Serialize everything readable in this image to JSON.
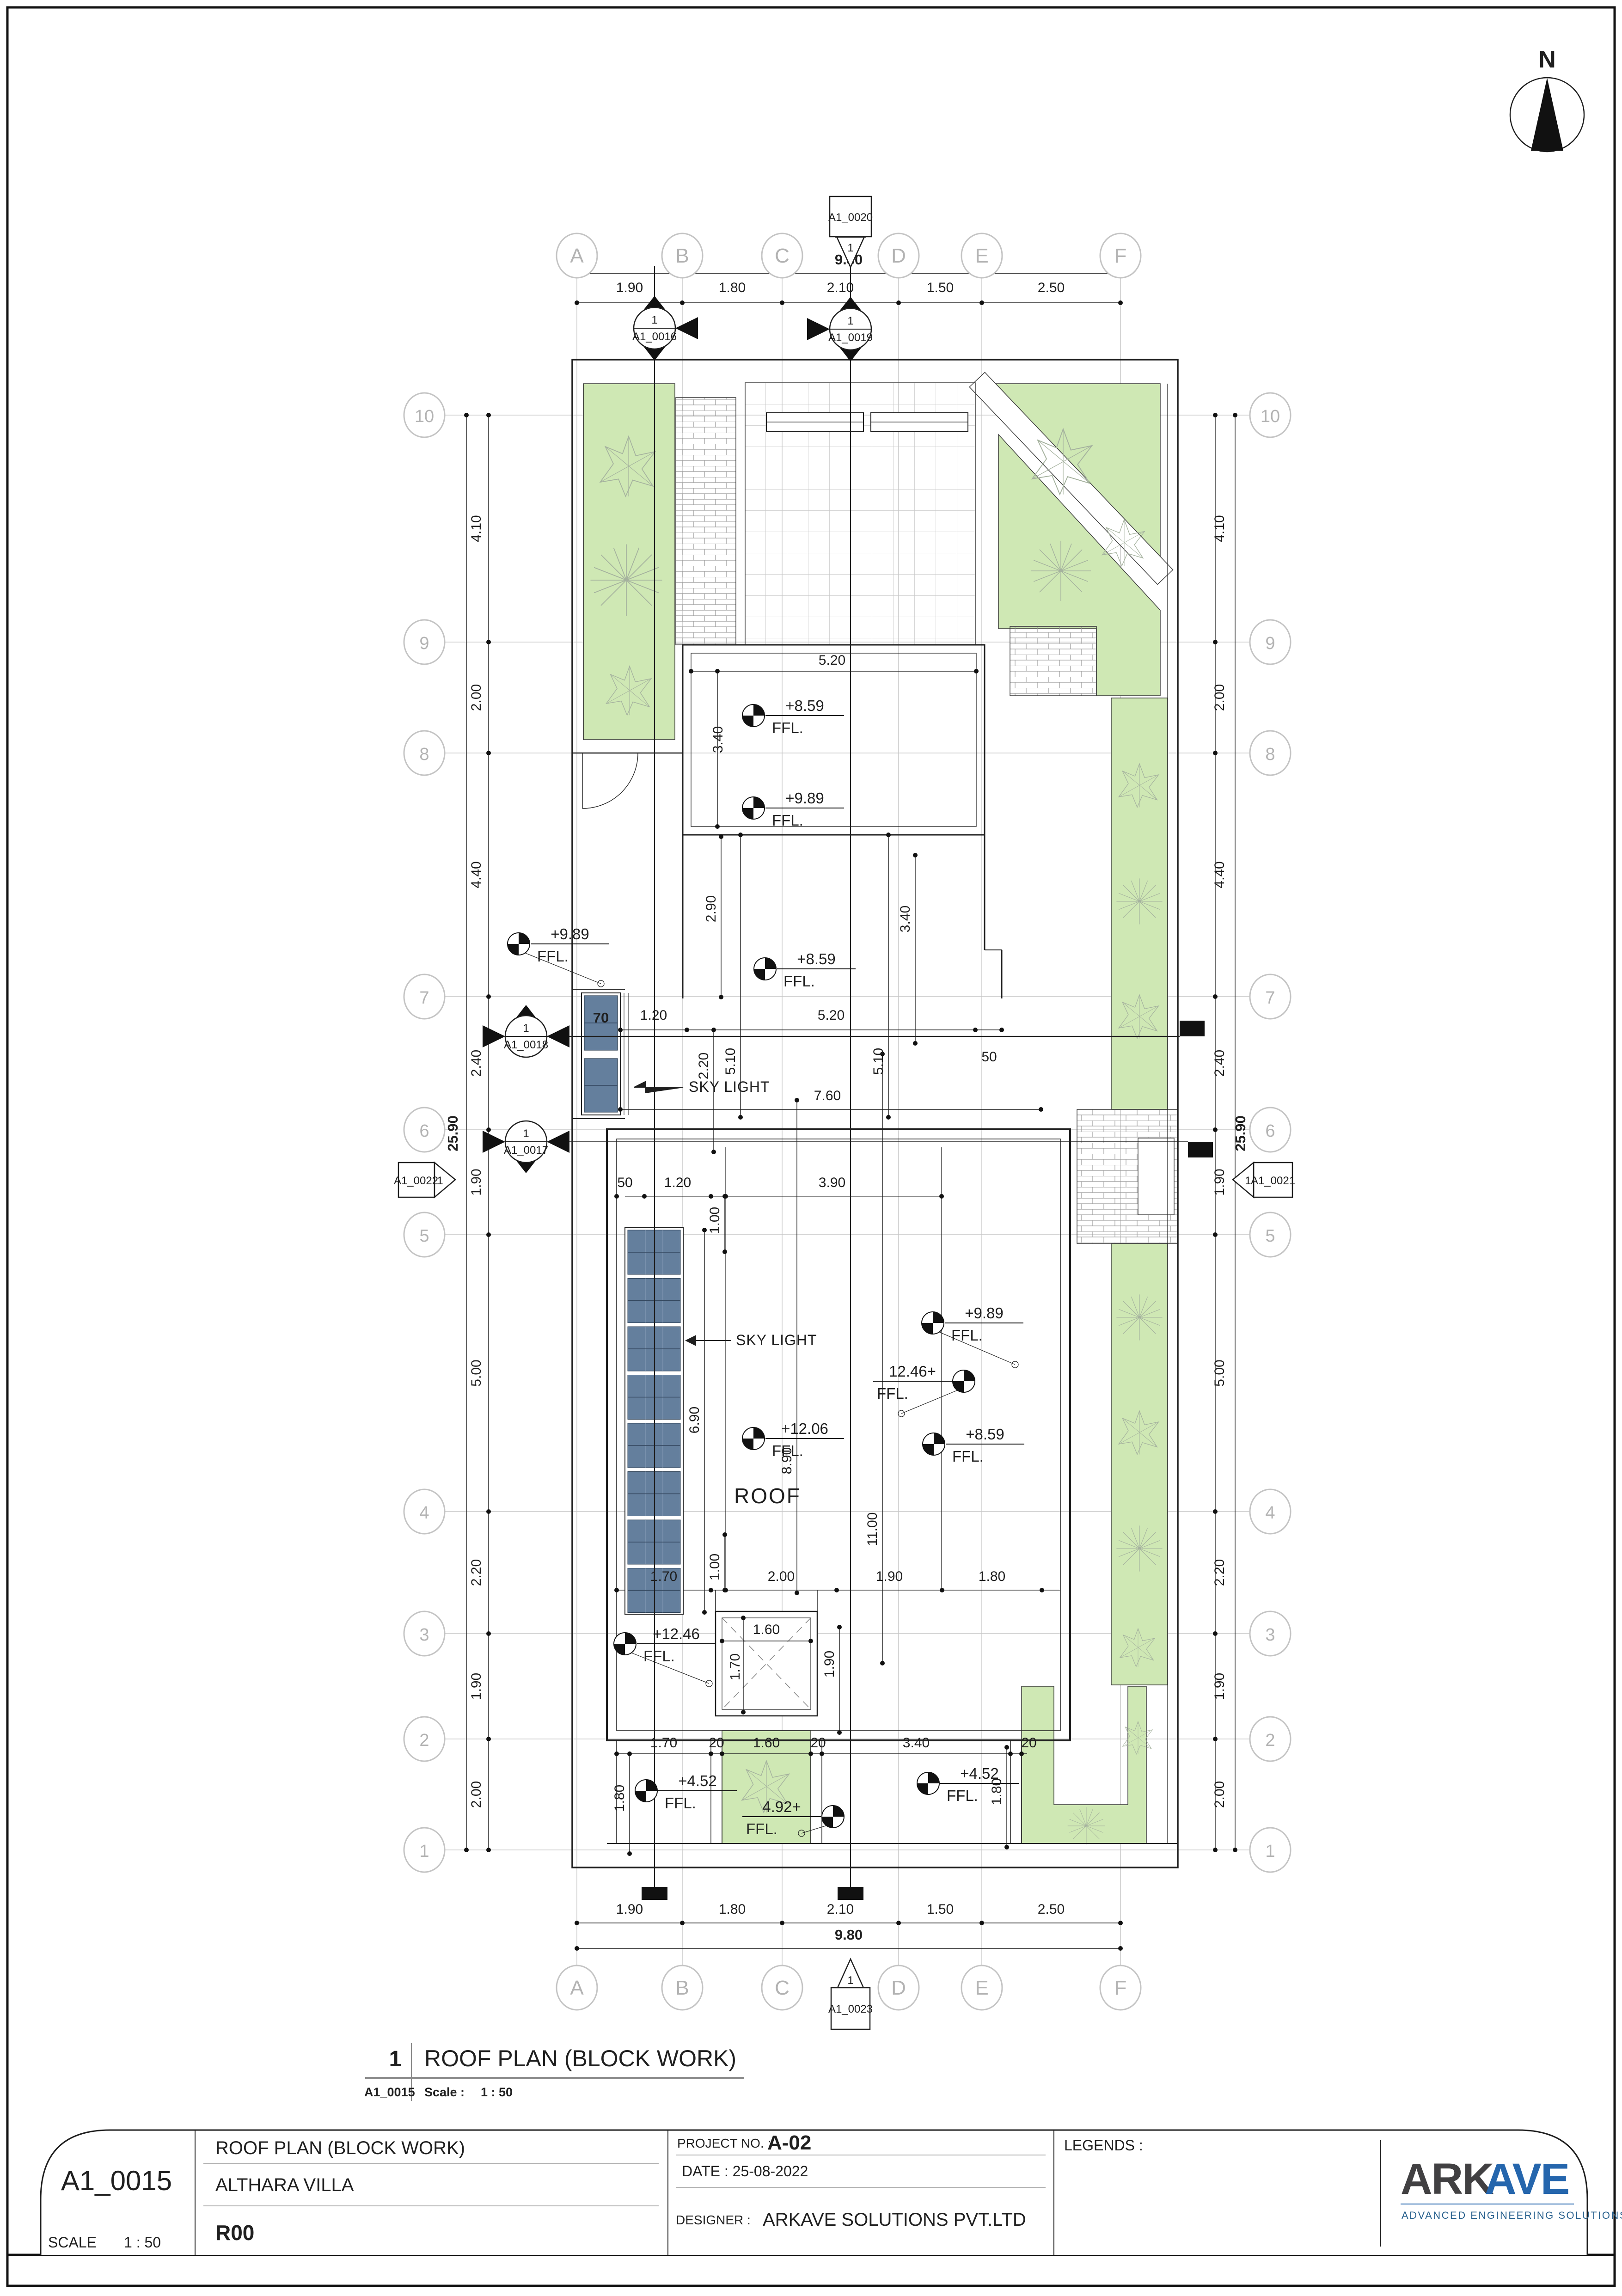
{
  "north": "N",
  "grid": {
    "cols": [
      "A",
      "B",
      "C",
      "D",
      "E",
      "F"
    ],
    "rows": [
      "10",
      "9",
      "8",
      "7",
      "6",
      "5",
      "4",
      "3",
      "2",
      "1"
    ],
    "col_dims": [
      "1.90",
      "1.80",
      "2.10",
      "1.50",
      "2.50"
    ],
    "total_w": "9.80",
    "row_dims": [
      "4.10",
      "2.00",
      "4.40",
      "2.40",
      "1.90",
      "5.00",
      "2.20",
      "1.90",
      "2.00"
    ],
    "total_h": "25.90"
  },
  "markers": {
    "m16": "A1_0016",
    "m17": "A1_0017",
    "m18": "A1_0018",
    "m19": "A1_0019",
    "m20": "A1_0020",
    "m21": "A1_0021",
    "m22": "A1_0022",
    "m23": "A1_0023",
    "num": "1"
  },
  "levels": {
    "v989": "+9.89",
    "v859": "+8.59",
    "v1206": "+12.06",
    "v1246": "12.46+",
    "v1246p": "+12.46",
    "v452": "+4.52",
    "v492": "4.92+",
    "ffl": "FFL."
  },
  "dims": {
    "d20": "20",
    "d50": "50",
    "d70": "70",
    "d100": "1.00",
    "d120": "1.20",
    "d160": "1.60",
    "d170": "1.70",
    "d180": "1.80",
    "d190": "1.90",
    "d200": "2.00",
    "d220": "2.20",
    "d290": "2.90",
    "d340": "3.40",
    "d390": "3.90",
    "d510": "5.10",
    "d520": "5.20",
    "d690": "6.90",
    "d760": "7.60",
    "d890": "8.90",
    "d980": "9.80",
    "d1100": "11.00",
    "d2590": "25.90"
  },
  "labels": {
    "sky_light": "SKY LIGHT",
    "roof": "ROOF"
  },
  "drawing_title": {
    "num": "1",
    "title": "ROOF PLAN (BLOCK WORK)",
    "ref": "A1_0015",
    "scale_label": "Scale :",
    "scale": "1 : 50"
  },
  "title_block": {
    "sheet_no": "A1_0015",
    "scale_label": "SCALE",
    "scale": "1 : 50",
    "title": "ROOF PLAN (BLOCK WORK)",
    "project": "ALTHARA VILLA",
    "revision": "R00",
    "project_no_label": "PROJECT NO. :",
    "project_no": "A-02",
    "date": "DATE : 25-08-2022",
    "designer_label": "DESIGNER :",
    "designer": "ARKAVE SOLUTIONS PVT.LTD",
    "legends_label": "LEGENDS :",
    "logo_part1": "ARK",
    "logo_part2": "AVE",
    "logo_tagline": "ADVANCED ENGINEERING SOLUTIONS"
  }
}
